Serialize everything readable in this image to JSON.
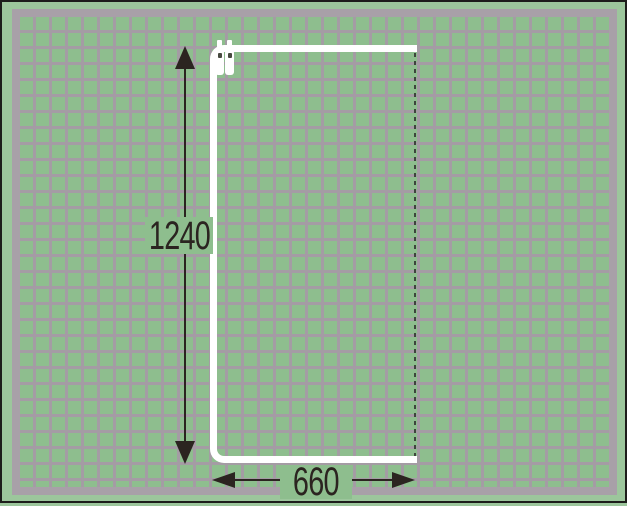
{
  "diagram": {
    "dimension_vertical": {
      "value": "1240"
    },
    "dimension_horizontal": {
      "value": "660"
    }
  },
  "icons": {
    "glider": "curtain-glider-icon",
    "arrow_up": "arrow-up-icon",
    "arrow_down": "arrow-down-icon",
    "arrow_left": "arrow-left-icon",
    "arrow_right": "arrow-right-icon"
  },
  "theme": {
    "margin-green": "#9cc69c",
    "tile-green": "#8ebe8e",
    "grout-gray": "#a49ca4",
    "band-gray": "#a8a0a8",
    "frame-black": "#1d1d1b",
    "rail-white": "#ffffff",
    "dim-color": "#2b2420",
    "dash-color": "#3c463c",
    "glider-hole": "#474a40"
  }
}
